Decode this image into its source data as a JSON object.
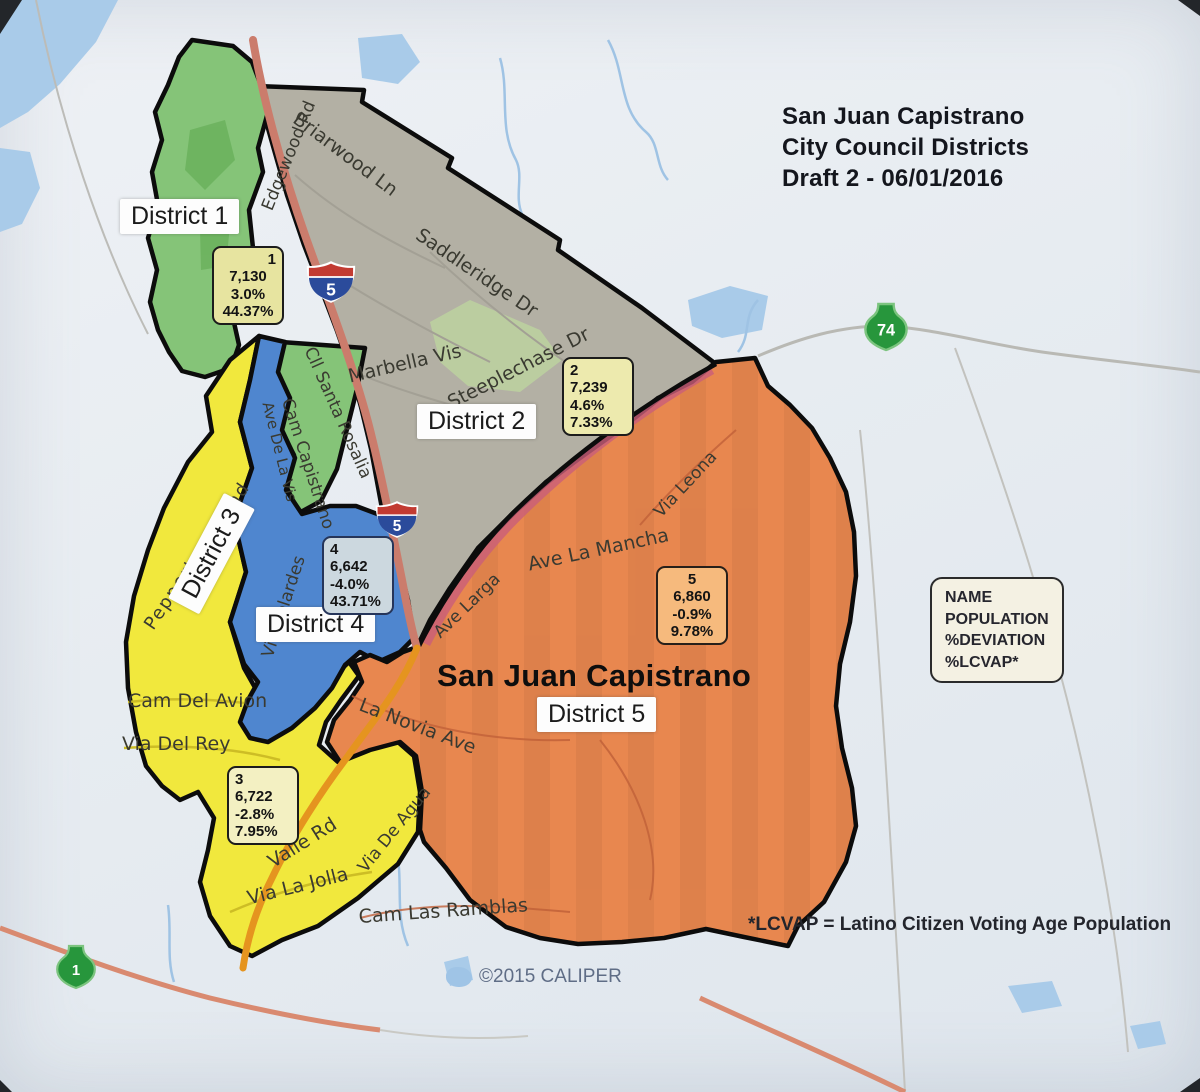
{
  "title": {
    "line1": "San Juan Capistrano",
    "line2": "City Council Districts",
    "line3": "Draft 2 - 06/01/2016"
  },
  "map": {
    "city_label": "San Juan Capistrano",
    "districts": [
      {
        "num": "1",
        "name": "District 1",
        "population": "7,130",
        "deviation": "3.0%",
        "lcvap": "44.37%",
        "color": "#85c478"
      },
      {
        "num": "2",
        "name": "District 2",
        "population": "7,239",
        "deviation": "4.6%",
        "lcvap": "7.33%",
        "color": "#b3b0a4"
      },
      {
        "num": "3",
        "name": "District 3",
        "population": "6,722",
        "deviation": "-2.8%",
        "lcvap": "7.95%",
        "color": "#f1e83d"
      },
      {
        "num": "4",
        "name": "District 4",
        "population": "6,642",
        "deviation": "-4.0%",
        "lcvap": "43.71%",
        "color": "#4f86cf"
      },
      {
        "num": "5",
        "name": "District 5",
        "population": "6,860",
        "deviation": "-0.9%",
        "lcvap": "9.78%",
        "color": "#e8874f"
      }
    ],
    "roads": {
      "briarwood": "Briarwood Ln",
      "edgewood": "Edgewood Rd",
      "saddleridge": "Saddleridge Dr",
      "marbella": "Marbella Vis",
      "steeplechase": "Steeplechase Dr",
      "cll_santa_rosalia": "Cll Santa Rosalia",
      "cam_capistrano": "Cam Capistrano",
      "ave_de_la_vis": "Ave De La Vis",
      "via_belardes": "Via Belardes",
      "peppertree": "Peppertree Bend",
      "cam_del_avion": "Cam Del Avion",
      "via_del_rey": "Via Del Rey",
      "valle_rd": "Valle Rd",
      "via_la_jolla": "Via La Jolla",
      "via_de_agua": "Via De Agua",
      "cam_las_ramblas": "Cam Las Ramblas",
      "la_novia": "La Novia Ave",
      "ave_larga": "Ave Larga",
      "ave_la_mancha": "Ave La Mancha",
      "via_leona": "Via Leona"
    },
    "shields": {
      "interstate": "5",
      "route74": "74",
      "route1": "1"
    },
    "colors": {
      "water": "#a9cbe9",
      "freeway": "#cb7c6c",
      "boundary": "#0c0c0c"
    }
  },
  "legend": {
    "line1": "NAME",
    "line2": "POPULATION",
    "line3": "%DEVIATION",
    "line4": "%LCVAP*"
  },
  "footnote": "*LCVAP = Latino Citizen Voting Age Population",
  "copyright": "©2015 CALIPER"
}
